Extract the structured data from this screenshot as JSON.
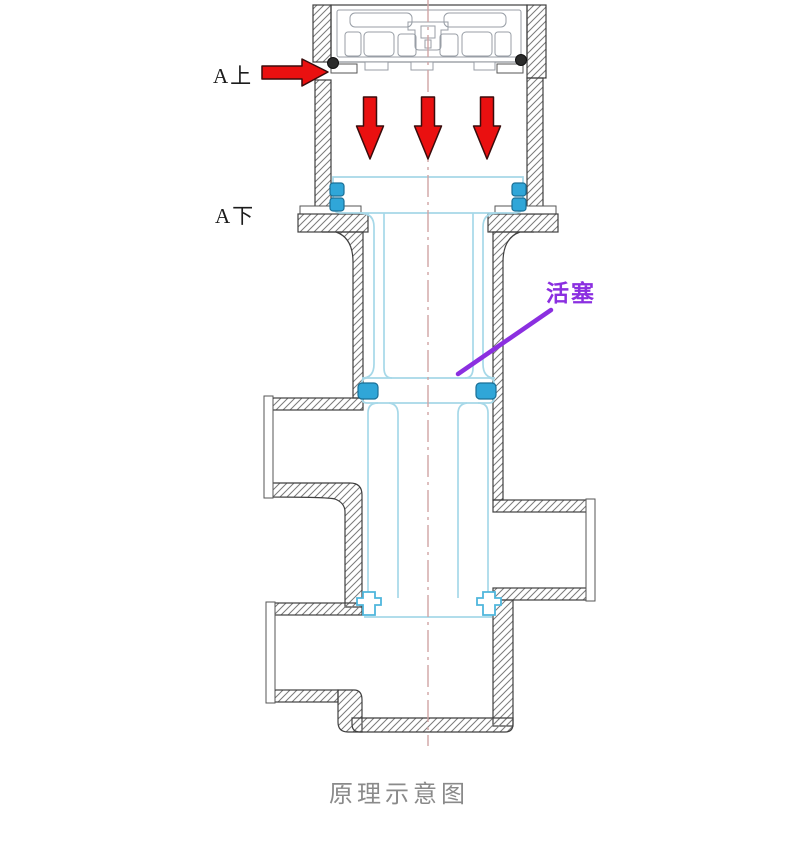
{
  "page": {
    "background": "#ffffff"
  },
  "diagram": {
    "caption": "原理示意图",
    "labels": {
      "upper_port": "A上",
      "lower_port": "A下",
      "piston": "活塞"
    },
    "annotations": {
      "down_arrow_count": 3,
      "inlet_arrow_direction": "right",
      "down_arrow_direction": "down"
    },
    "icons": {
      "inlet_arrow": "flow-arrow-right-icon",
      "pressure_arrows": "flow-arrow-down-icon"
    },
    "colors": {
      "arrow_red": "#ea1010",
      "piston_cyan": "#a6d8e8",
      "seal_blue": "#30a6d8",
      "centerline_pink": "#d0a4a4",
      "label_purple": "#8b2fe0",
      "caption_gray": "#8a8a8a",
      "body_outline": "#3f3f3f"
    }
  }
}
